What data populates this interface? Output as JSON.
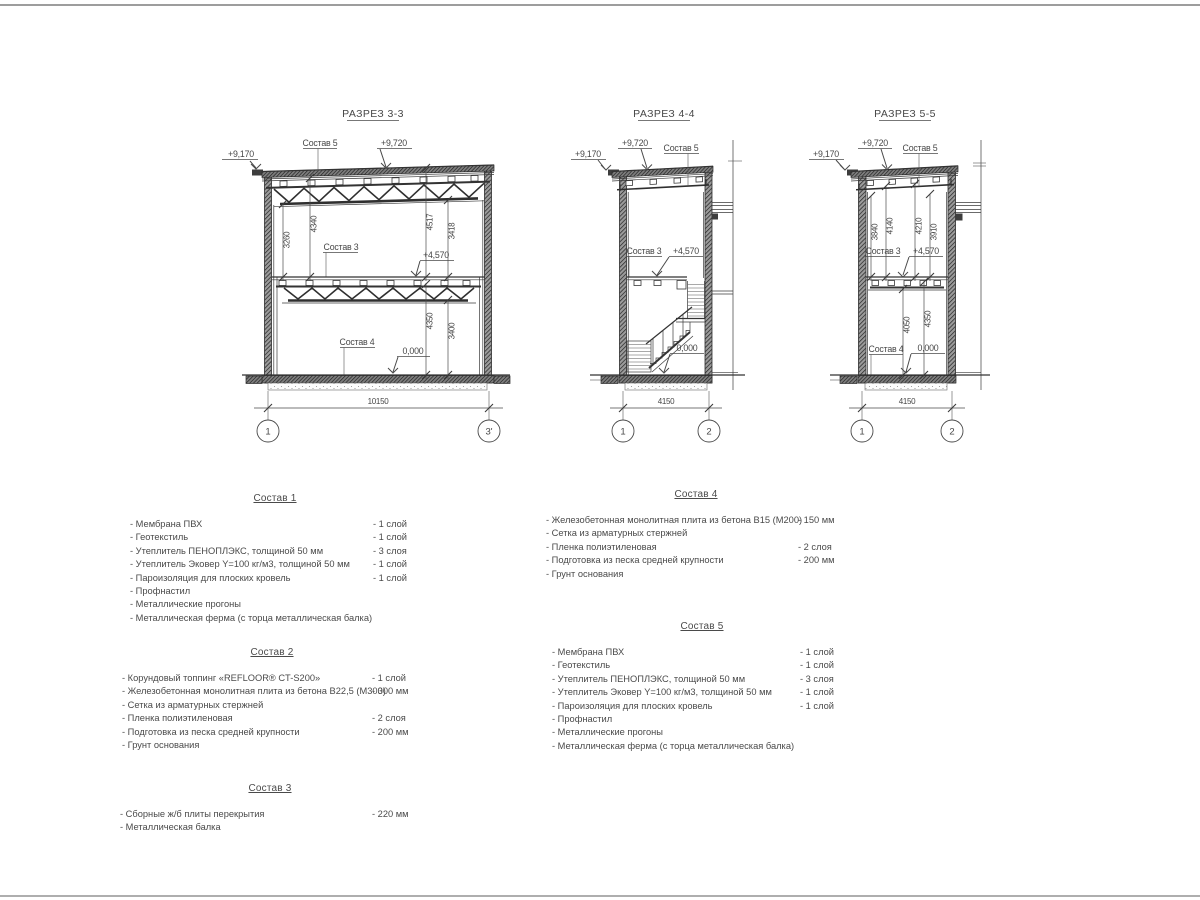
{
  "colors": {
    "ink": "#3a3a3a",
    "text": "#474747",
    "page_rule": "#a8a8a8"
  },
  "sections": {
    "s33": {
      "title": "РАЗРЕЗ 3-3",
      "elev_left": "+9,170",
      "elev_top": "+9,720",
      "elev_mid": "+4,570",
      "elev_zero": "0,000",
      "sostav5": "Состав 5",
      "sostav3": "Состав 3",
      "sostav4": "Состав 4",
      "dims": [
        "3260",
        "4340",
        "4517",
        "3418",
        "4350",
        "3400"
      ],
      "width": "10150",
      "ax_l": "1",
      "ax_r": "3'"
    },
    "s44": {
      "title": "РАЗРЕЗ 4-4",
      "elev_left": "+9,170",
      "elev_top": "+9,720",
      "elev_mid": "+4,570",
      "elev_zero": "0,000",
      "sostav5": "Состав 5",
      "sostav3": "Состав 3",
      "width": "4150",
      "ax_l": "1",
      "ax_r": "2"
    },
    "s55": {
      "title": "РАЗРЕЗ 5-5",
      "elev_left": "+9,170",
      "elev_top": "+9,720",
      "elev_mid": "+4,570",
      "elev_zero": "0,000",
      "sostav5": "Состав 5",
      "sostav3": "Состав 3",
      "sostav4": "Состав 4",
      "dims": [
        "3840",
        "4140",
        "4210",
        "3910",
        "4050",
        "4350"
      ],
      "width": "4150",
      "ax_l": "1",
      "ax_r": "2"
    }
  },
  "compositions": [
    {
      "title": "Состав 1",
      "items": [
        {
          "name": "- Мембрана ПВХ",
          "value": "- 1 слой"
        },
        {
          "name": "- Геотекстиль",
          "value": "- 1 слой"
        },
        {
          "name": "- Утеплитель ПЕНОПЛЭКС, толщиной 50 мм",
          "value": "- 3 слоя"
        },
        {
          "name": "- Утеплитель Эковер Y=100 кг/м3, толщиной 50 мм",
          "value": "- 1 слой"
        },
        {
          "name": "- Пароизоляция для плоских кровель",
          "value": "- 1 слой"
        },
        {
          "name": "- Профнастил",
          "value": ""
        },
        {
          "name": "- Металлические прогоны",
          "value": ""
        },
        {
          "name": "- Металлическая ферма (с торца металлическая балка)",
          "value": ""
        }
      ]
    },
    {
      "title": "Состав 2",
      "items": [
        {
          "name": "- Корундовый топпинг «REFLOOR® CT-S200»",
          "value": "- 1 слой"
        },
        {
          "name": "- Железобетонная  монолитная плита из бетона В22,5 (М300)",
          "value": "- 300 мм"
        },
        {
          "name": "- Сетка из арматурных стержней",
          "value": ""
        },
        {
          "name": "- Пленка полиэтиленовая",
          "value": "- 2 слоя"
        },
        {
          "name": "- Подготовка из песка средней крупности",
          "value": "- 200 мм"
        },
        {
          "name": "- Грунт основания",
          "value": ""
        }
      ]
    },
    {
      "title": "Состав 3",
      "items": [
        {
          "name": "- Сборные ж/б плиты перекрытия",
          "value": "- 220 мм"
        },
        {
          "name": "- Металлическая балка",
          "value": ""
        }
      ]
    },
    {
      "title": "Состав 4",
      "items": [
        {
          "name": "- Железобетонная  монолитная плита из бетона В15 (М200)",
          "value": "- 150 мм"
        },
        {
          "name": "- Сетка из арматурных стержней",
          "value": ""
        },
        {
          "name": "- Пленка полиэтиленовая",
          "value": "- 2 слоя"
        },
        {
          "name": "- Подготовка из песка средней крупности",
          "value": "- 200 мм"
        },
        {
          "name": "- Грунт основания",
          "value": ""
        }
      ]
    },
    {
      "title": "Состав 5",
      "items": [
        {
          "name": "- Мембрана ПВХ",
          "value": "- 1 слой"
        },
        {
          "name": "- Геотекстиль",
          "value": "- 1 слой"
        },
        {
          "name": "- Утеплитель ПЕНОПЛЭКС, толщиной 50 мм",
          "value": "- 3 слоя"
        },
        {
          "name": "- Утеплитель Эковер Y=100 кг/м3, толщиной 50 мм",
          "value": "- 1 слой"
        },
        {
          "name": "- Пароизоляция для плоских кровель",
          "value": "- 1 слой"
        },
        {
          "name": "- Профнастил",
          "value": ""
        },
        {
          "name": "- Металлические прогоны",
          "value": ""
        },
        {
          "name": "- Металлическая ферма (с торца металлическая балка)",
          "value": ""
        }
      ]
    }
  ]
}
